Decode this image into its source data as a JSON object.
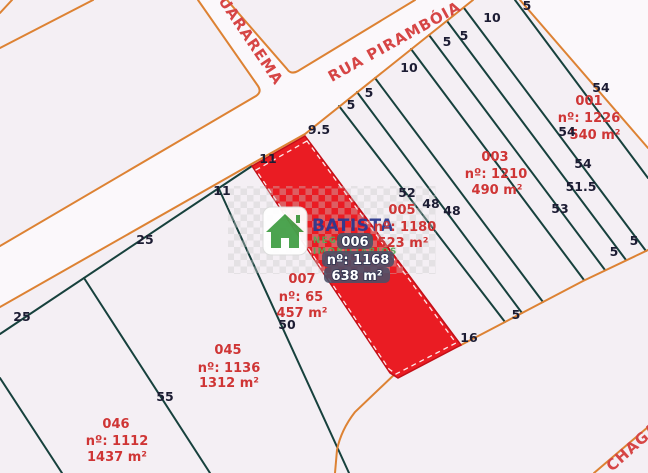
{
  "streets": {
    "guararema": "GUARAREMA",
    "piramboia": "RUA PIRAMBÓIA",
    "chagas": "CHAGAS"
  },
  "parcels": {
    "p001": {
      "id": "001",
      "registry": "nº: 1226",
      "area": "540 m²"
    },
    "p003": {
      "id": "003",
      "registry": "nº: 1210",
      "area": "490 m²"
    },
    "p005": {
      "id": "005",
      "registry": "nº: 1180",
      "area": "523 m²"
    },
    "p006": {
      "id": "006",
      "registry": "nº: 1168",
      "area": "638 m²",
      "highlighted": true,
      "highlight_color": "#ea1c23"
    },
    "p007": {
      "id": "007",
      "registry": "nº: 65",
      "area": "457 m²"
    },
    "p045": {
      "id": "045",
      "registry": "nº: 1136",
      "area": "1312 m²"
    },
    "p046": {
      "id": "046",
      "registry": "nº: 1112",
      "area": "1437 m²"
    }
  },
  "dims": [
    "9.5",
    "11",
    "11",
    "25",
    "25",
    "55",
    "50",
    "52",
    "48",
    "48",
    "5",
    "5",
    "10",
    "5",
    "5",
    "10",
    "5",
    "54",
    "54",
    "54",
    "51.5",
    "53",
    "5",
    "5",
    "5",
    "16"
  ],
  "watermark": {
    "brand": "BATISTA",
    "tagline1": "NEGÓCIOS",
    "tagline2": "IMOBILIÁRIOS"
  },
  "colors": {
    "street_line": "#dd8233",
    "lot_line": "#17413d",
    "highlight": "#ea1c23",
    "parcel_label": "#cf3535",
    "dimension_label": "#1c1c33",
    "background": "#f4eff4"
  }
}
